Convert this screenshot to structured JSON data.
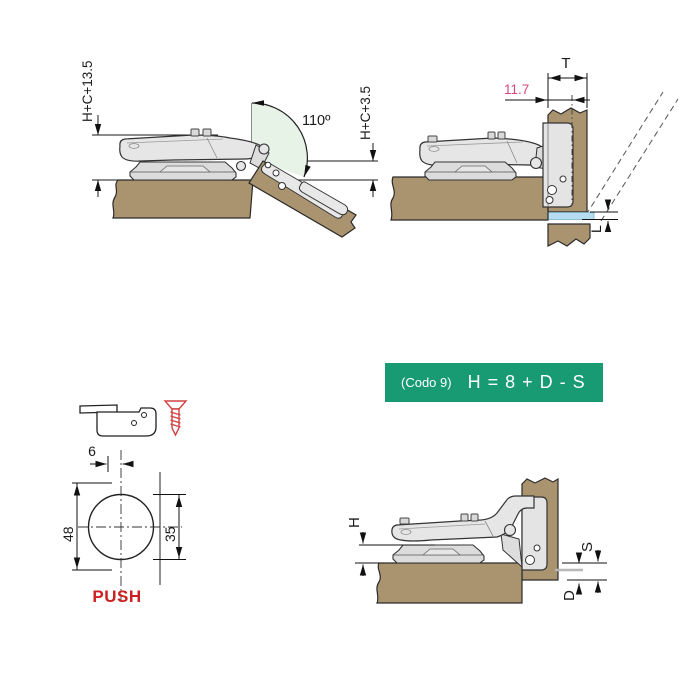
{
  "colors": {
    "wood": "#aa9470",
    "hinge_metal": "#e6e6e6",
    "plate_metal": "#dcdcdc",
    "arc_green": "#e8f3e8",
    "gap_blue": "#b5dcf0",
    "accent_green": "#189a72",
    "pink": "#d6477d",
    "red": "#cc2020",
    "screw_red": "#cf4242"
  },
  "open_hinge": {
    "dim_left": "H+C+13.5",
    "angle": "110º",
    "dim_right": "H+C+3.5"
  },
  "closed_hinge": {
    "thickness": "T",
    "offset": "11.7",
    "gap": "L"
  },
  "formula": {
    "code": "(Codo 9)",
    "equation": "H = 8 + D - S"
  },
  "drilling": {
    "edge_distance": "6",
    "plate_height": "48",
    "cup_diameter": "35",
    "push": "PUSH"
  },
  "mounted": {
    "plate": "H",
    "gap": "S",
    "overlay": "D"
  }
}
